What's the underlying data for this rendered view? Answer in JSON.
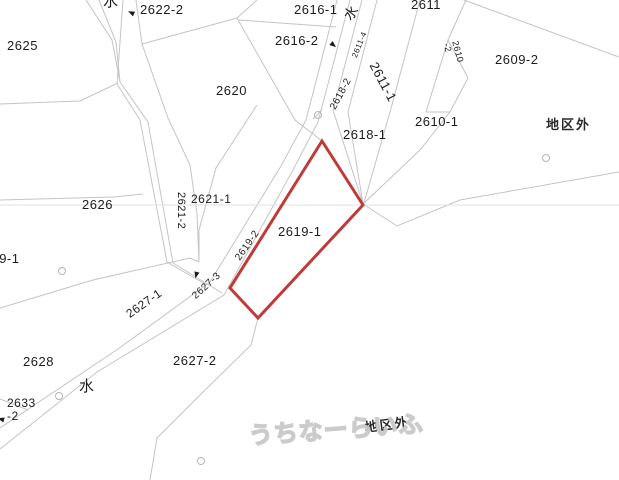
{
  "map": {
    "title": "cadastral parcel map",
    "highlighted_parcel_id": "2619-1",
    "colors": {
      "background": "#ffffff",
      "boundary_line": "#c4c4c4",
      "sheet_line": "#e0e0e0",
      "highlight_red": "#c13a3a",
      "text": "#1c1c1c",
      "watermark_outline": "#c9c9c9"
    },
    "watermark_text": "うちなーらいふ",
    "district_outside_text": "地区外",
    "water_text": "水",
    "labels": [
      {
        "id": "water-top",
        "text": "水",
        "x": 103,
        "y": -6,
        "size": 15,
        "style": "water"
      },
      {
        "id": "lot-2622-2",
        "text": "2622-2",
        "x": 140,
        "y": 3,
        "size": 13
      },
      {
        "id": "lot-2625",
        "text": "2625",
        "x": 7,
        "y": 39,
        "size": 13
      },
      {
        "id": "lot-2616-1",
        "text": "2616-1",
        "x": 294,
        "y": 3,
        "size": 13
      },
      {
        "id": "lot-2616-2",
        "text": "2616-2",
        "x": 275,
        "y": 34,
        "size": 13
      },
      {
        "id": "water-ne",
        "text": "水",
        "x": 341,
        "y": 14,
        "size": 14,
        "rot": -52,
        "style": "water"
      },
      {
        "id": "lot-2611",
        "text": "2611",
        "x": 411,
        "y": -2,
        "size": 13
      },
      {
        "id": "lot-2620",
        "text": "2620",
        "x": 216,
        "y": 84,
        "size": 13
      },
      {
        "id": "lot-2611-4",
        "text": "2611-4",
        "x": 351,
        "y": 56,
        "size": 8,
        "rot": -68
      },
      {
        "id": "lot-2618-2",
        "text": "2618-2",
        "x": 329,
        "y": 107,
        "size": 10,
        "rot": -62
      },
      {
        "id": "lot-2611-1",
        "text": "2611-1",
        "x": 379,
        "y": 60,
        "size": 13,
        "rot": 62
      },
      {
        "id": "lot-2610-2",
        "text": "2610-2",
        "lines": [
          "2610",
          "-2"
        ],
        "x": 459,
        "y": 40,
        "size": 9,
        "rot": 75
      },
      {
        "id": "lot-2609-2",
        "text": "2609-2",
        "x": 495,
        "y": 53,
        "size": 13
      },
      {
        "id": "lot-2610-1",
        "text": "2610-1",
        "x": 415,
        "y": 115,
        "size": 13
      },
      {
        "id": "district-east",
        "text": "地区外",
        "x": 546,
        "y": 118,
        "size": 13,
        "style": "district"
      },
      {
        "id": "lot-2618-1",
        "text": "2618-1",
        "x": 343,
        "y": 128,
        "size": 13
      },
      {
        "id": "lot-2619-1",
        "text": "2619-1",
        "x": 278,
        "y": 225,
        "size": 13
      },
      {
        "id": "lot-2619-2",
        "text": "2619-2",
        "x": 234,
        "y": 257,
        "size": 10,
        "rot": -55
      },
      {
        "id": "lot-2626",
        "text": "2626",
        "x": 82,
        "y": 198,
        "size": 13
      },
      {
        "id": "lot-2621-1",
        "text": "2621-1",
        "x": 191,
        "y": 193,
        "size": 12
      },
      {
        "id": "lot-2621-2",
        "text": "2621-2",
        "x": 186,
        "y": 192,
        "size": 11,
        "rot": 90
      },
      {
        "id": "lot-2629-1",
        "text": "2629-1",
        "x": -24,
        "y": 252,
        "size": 13
      },
      {
        "id": "lot-2627-1",
        "text": "2627-1",
        "x": 124,
        "y": 310,
        "size": 12,
        "rot": -35
      },
      {
        "id": "lot-2627-3",
        "text": "2627-3",
        "x": 191,
        "y": 294,
        "size": 10,
        "rot": -42
      },
      {
        "id": "lot-2627-2",
        "text": "2627-2",
        "x": 173,
        "y": 354,
        "size": 13
      },
      {
        "id": "lot-2628",
        "text": "2628",
        "x": 23,
        "y": 355,
        "size": 13
      },
      {
        "id": "water-sw",
        "text": "水",
        "x": 79,
        "y": 379,
        "size": 15,
        "style": "water"
      },
      {
        "id": "lot-2633-2",
        "text": "2633-2",
        "lines": [
          "2633",
          "-2"
        ],
        "x": 7,
        "y": 397,
        "size": 12
      },
      {
        "id": "district-south",
        "text": "地区外",
        "x": 364,
        "y": 421,
        "size": 13,
        "rot": -7,
        "style": "district"
      },
      {
        "id": "watermark",
        "text": "うちなーらいふ",
        "x": 248,
        "y": 424,
        "size": 24,
        "rot": -4,
        "style": "watermark"
      }
    ],
    "geometry": {
      "highlight": {
        "id": "2619-1",
        "points": [
          [
            322,
            141
          ],
          [
            363,
            205
          ],
          [
            258,
            318
          ],
          [
            230,
            288
          ]
        ]
      },
      "boundaries": [
        {
          "pts": [
            [
              86,
              0
            ],
            [
              112,
              40
            ],
            [
              120,
              82
            ]
          ]
        },
        {
          "pts": [
            [
              99,
              0
            ],
            [
              116,
              42
            ],
            [
              120,
              82
            ]
          ]
        },
        {
          "pts": [
            [
              123,
              0
            ],
            [
              117,
              84
            ]
          ]
        },
        {
          "pts": [
            [
              136,
              0
            ],
            [
              142,
              44
            ],
            [
              168,
              118
            ]
          ]
        },
        {
          "pts": [
            [
              142,
              44
            ],
            [
              237,
              18
            ]
          ]
        },
        {
          "pts": [
            [
              257,
              0
            ],
            [
              237,
              18
            ],
            [
              295,
              120
            ],
            [
              322,
              141
            ]
          ]
        },
        {
          "pts": [
            [
              239,
              20
            ],
            [
              336,
              27
            ]
          ]
        },
        {
          "pts": [
            [
              0,
              104
            ],
            [
              80,
              101
            ],
            [
              118,
              83
            ]
          ]
        },
        {
          "pts": [
            [
              117,
              84
            ],
            [
              140,
              120
            ],
            [
              167,
              262
            ],
            [
              205,
              284
            ]
          ]
        },
        {
          "pts": [
            [
              120,
              82
            ],
            [
              148,
              122
            ],
            [
              173,
              263
            ],
            [
              222,
              293
            ]
          ]
        },
        {
          "pts": [
            [
              168,
              118
            ],
            [
              190,
              165
            ],
            [
              197,
              214
            ],
            [
              199,
              262
            ]
          ]
        },
        {
          "pts": [
            [
              257,
              105
            ],
            [
              216,
              168
            ],
            [
              199,
              230
            ],
            [
              199,
              262
            ]
          ]
        },
        {
          "pts": [
            [
              0,
              200
            ],
            [
              113,
              197
            ],
            [
              143,
              194
            ]
          ]
        },
        {
          "pts": [
            [
              0,
              308
            ],
            [
              93,
              280
            ],
            [
              190,
              258
            ],
            [
              199,
              262
            ]
          ]
        },
        {
          "pts": [
            [
              337,
              0
            ],
            [
              306,
              120
            ],
            [
              281,
              166
            ],
            [
              210,
              282
            ],
            [
              118,
              349
            ],
            [
              0,
              428
            ]
          ]
        },
        {
          "pts": [
            [
              350,
              0
            ],
            [
              318,
              122
            ],
            [
              293,
              170
            ],
            [
              224,
              295
            ],
            [
              97,
              372
            ],
            [
              0,
              449
            ]
          ]
        },
        {
          "pts": [
            [
              362,
              0
            ],
            [
              333,
              110
            ],
            [
              363,
              204
            ]
          ]
        },
        {
          "pts": [
            [
              377,
              0
            ],
            [
              348,
              112
            ],
            [
              363,
              204
            ]
          ]
        },
        {
          "pts": [
            [
              420,
              0
            ],
            [
              390,
              112
            ],
            [
              364,
              203
            ]
          ]
        },
        {
          "pts": [
            [
              466,
              0
            ],
            [
              448,
              40
            ]
          ]
        },
        {
          "pts": [
            [
              448,
              40
            ],
            [
              426,
              112
            ],
            [
              450,
              112
            ]
          ]
        },
        {
          "pts": [
            [
              448,
              40
            ],
            [
              468,
              78
            ],
            [
              450,
              112
            ]
          ]
        },
        {
          "pts": [
            [
              464,
              0
            ],
            [
              619,
              57
            ]
          ]
        },
        {
          "pts": [
            [
              363,
              204
            ],
            [
              420,
              150
            ],
            [
              450,
              112
            ]
          ]
        },
        {
          "pts": [
            [
              363,
              204
            ],
            [
              397,
              226
            ],
            [
              460,
              200
            ],
            [
              619,
              172
            ]
          ]
        },
        {
          "pts": [
            [
              258,
              318
            ],
            [
              251,
              345
            ],
            [
              199,
              396
            ],
            [
              157,
              438
            ],
            [
              150,
              480
            ]
          ]
        },
        {
          "pts": [
            [
              0,
              399
            ],
            [
              28,
              410
            ]
          ]
        },
        {
          "pts": [
            [
              313,
              119
            ],
            [
              322,
              110
            ]
          ]
        },
        {
          "pts": [
            [
              0,
              205
            ],
            [
              619,
              205
            ]
          ],
          "light": true
        }
      ],
      "survey_circles": [
        [
          318,
          115
        ],
        [
          62,
          271
        ],
        [
          59,
          396
        ],
        [
          201,
          461
        ],
        [
          546,
          158
        ]
      ],
      "pointer_arrows": [
        {
          "x": 134,
          "y": 14,
          "rot": 205
        },
        {
          "x": 331,
          "y": 43,
          "rot": 40
        },
        {
          "x": 197,
          "y": 272,
          "rot": 105
        },
        {
          "x": 4,
          "y": 420,
          "rot": 195
        }
      ]
    }
  }
}
